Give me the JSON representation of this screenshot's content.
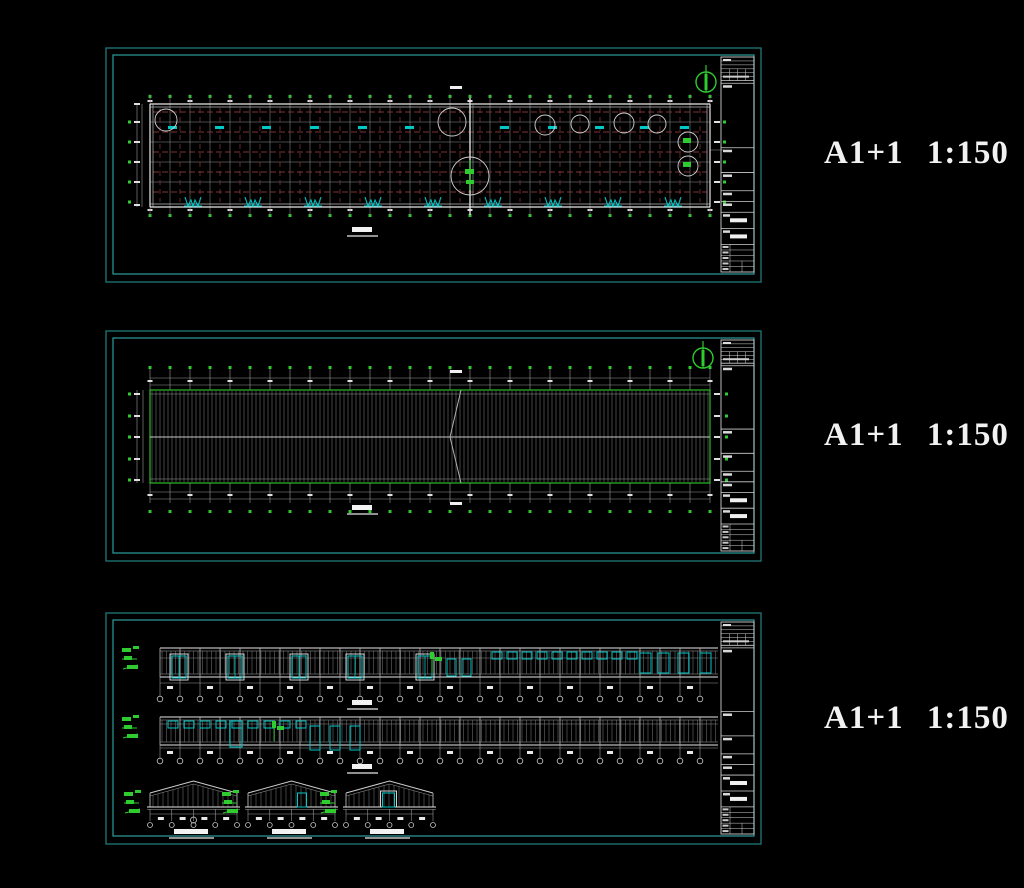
{
  "canvas": {
    "width": 1024,
    "height": 888,
    "background": "#000000"
  },
  "colors": {
    "border_teal": "#2c9d9d",
    "border_teal_dim": "#1d6f6f",
    "line_white": "#e8e8e8",
    "line_gray": "#9a9a9a",
    "line_faint": "#7c7c7c",
    "grid_red": "#7e3434",
    "accent_green": "#2ecc2e",
    "accent_cyan": "#00c8c8",
    "label_text": "#f2f2f2",
    "title_block_line": "#cfcfcf"
  },
  "side_labels": [
    {
      "text": "A1+1 1:150",
      "top": 135
    },
    {
      "text": "A1+1 1:150",
      "top": 417
    },
    {
      "text": "A1+1 1:150",
      "top": 700
    }
  ],
  "sheets": [
    {
      "name": "floor-plan-sheet",
      "type": "floor_plan",
      "box": {
        "x": 105,
        "y": 47,
        "w": 657,
        "h": 236
      }
    },
    {
      "name": "roof-plan-sheet",
      "type": "roof_plan",
      "box": {
        "x": 105,
        "y": 330,
        "w": 657,
        "h": 232
      }
    },
    {
      "name": "elevations-sheet",
      "type": "elevations",
      "box": {
        "x": 105,
        "y": 612,
        "w": 657,
        "h": 233
      }
    }
  ],
  "floor_plan": {
    "x0": 150,
    "x1": 710,
    "y_top": 104,
    "y_bottom": 205,
    "columns": 29,
    "white_rows": [
      122,
      142,
      162,
      182
    ],
    "red_rows": [
      112,
      132,
      152,
      172,
      192
    ],
    "door_xs": [
      185,
      245,
      305,
      365,
      425,
      485,
      545,
      605,
      665
    ],
    "cyan_tag_xs": [
      168,
      215,
      262,
      310,
      358,
      405,
      500,
      548,
      595,
      640,
      680
    ],
    "cyan_tag_y": 126,
    "callout_circles": [
      [
        166,
        120,
        11
      ],
      [
        452,
        122,
        14
      ],
      [
        470,
        176,
        19
      ],
      [
        545,
        125,
        10
      ],
      [
        580,
        124,
        9
      ],
      [
        624,
        123,
        10
      ],
      [
        657,
        124,
        9
      ],
      [
        688,
        142,
        10
      ],
      [
        688,
        166,
        10
      ]
    ],
    "expansion_col_x": 470,
    "left_dot_rows": [
      122,
      142,
      162,
      182,
      202
    ],
    "title_bar": {
      "x": 352,
      "y": 227
    },
    "north_arrow": {
      "x": 706,
      "y": 82
    }
  },
  "roof_plan": {
    "x0": 150,
    "x1": 710,
    "y_top": 390,
    "y_bottom": 483,
    "ridge_y": 437,
    "purlin_step": 4,
    "column_step": 20,
    "kink_x": 455,
    "top_dim": {
      "line1": 378,
      "line2": 385,
      "dot_y": 366
    },
    "bottom_dim": {
      "line1": 492,
      "line2": 499,
      "dot_y": 510
    },
    "side_dot_rows": [
      394,
      416,
      437,
      459,
      480
    ],
    "title_bar": {
      "x": 352,
      "y": 505
    },
    "north_arrow": {
      "x": 703,
      "y": 358
    }
  },
  "elevations": {
    "south": {
      "x0": 160,
      "x1": 718,
      "y_top": 648,
      "y_bottom": 677,
      "girt_y": 658,
      "framed_door_xs": [
        172,
        228,
        292,
        348,
        418
      ],
      "small_door_xs": [
        447,
        462
      ],
      "window_xs": [
        492,
        507,
        522,
        537,
        552,
        567,
        582,
        597,
        612,
        627
      ],
      "end_door_xs": [
        640,
        658,
        678,
        700
      ],
      "green_marker_xs": [
        430
      ],
      "dim": {
        "drop_bottom": 696,
        "line_y": 683,
        "tick_y": 686,
        "circle_y": 699
      },
      "title_bar": {
        "x": 352,
        "y": 700
      }
    },
    "north": {
      "x0": 160,
      "x1": 718,
      "y_top": 717,
      "y_bottom": 745,
      "girt_y": 724,
      "window_xs": [
        168,
        184,
        200,
        216,
        232,
        248,
        264,
        280,
        296
      ],
      "door_xs": [
        310,
        330,
        350
      ],
      "tall_door_x": 230,
      "green_marker_xs": [
        272
      ],
      "dim": {
        "drop_bottom": 758,
        "line_y": 748,
        "tick_y": 751,
        "circle_y": 761
      },
      "title_bar": {
        "x": 352,
        "y": 764
      }
    },
    "gables": [
      {
        "x": 150,
        "w": 87,
        "feature": "anchor-circle"
      },
      {
        "x": 248,
        "w": 87,
        "feature": "door-right"
      },
      {
        "x": 346,
        "w": 87,
        "feature": "door-center"
      }
    ],
    "gable_geometry": {
      "peak_y": 781,
      "eave_y": 793,
      "base_y": 807,
      "dim_circle_y": 825,
      "title_bar_y": 829
    }
  }
}
